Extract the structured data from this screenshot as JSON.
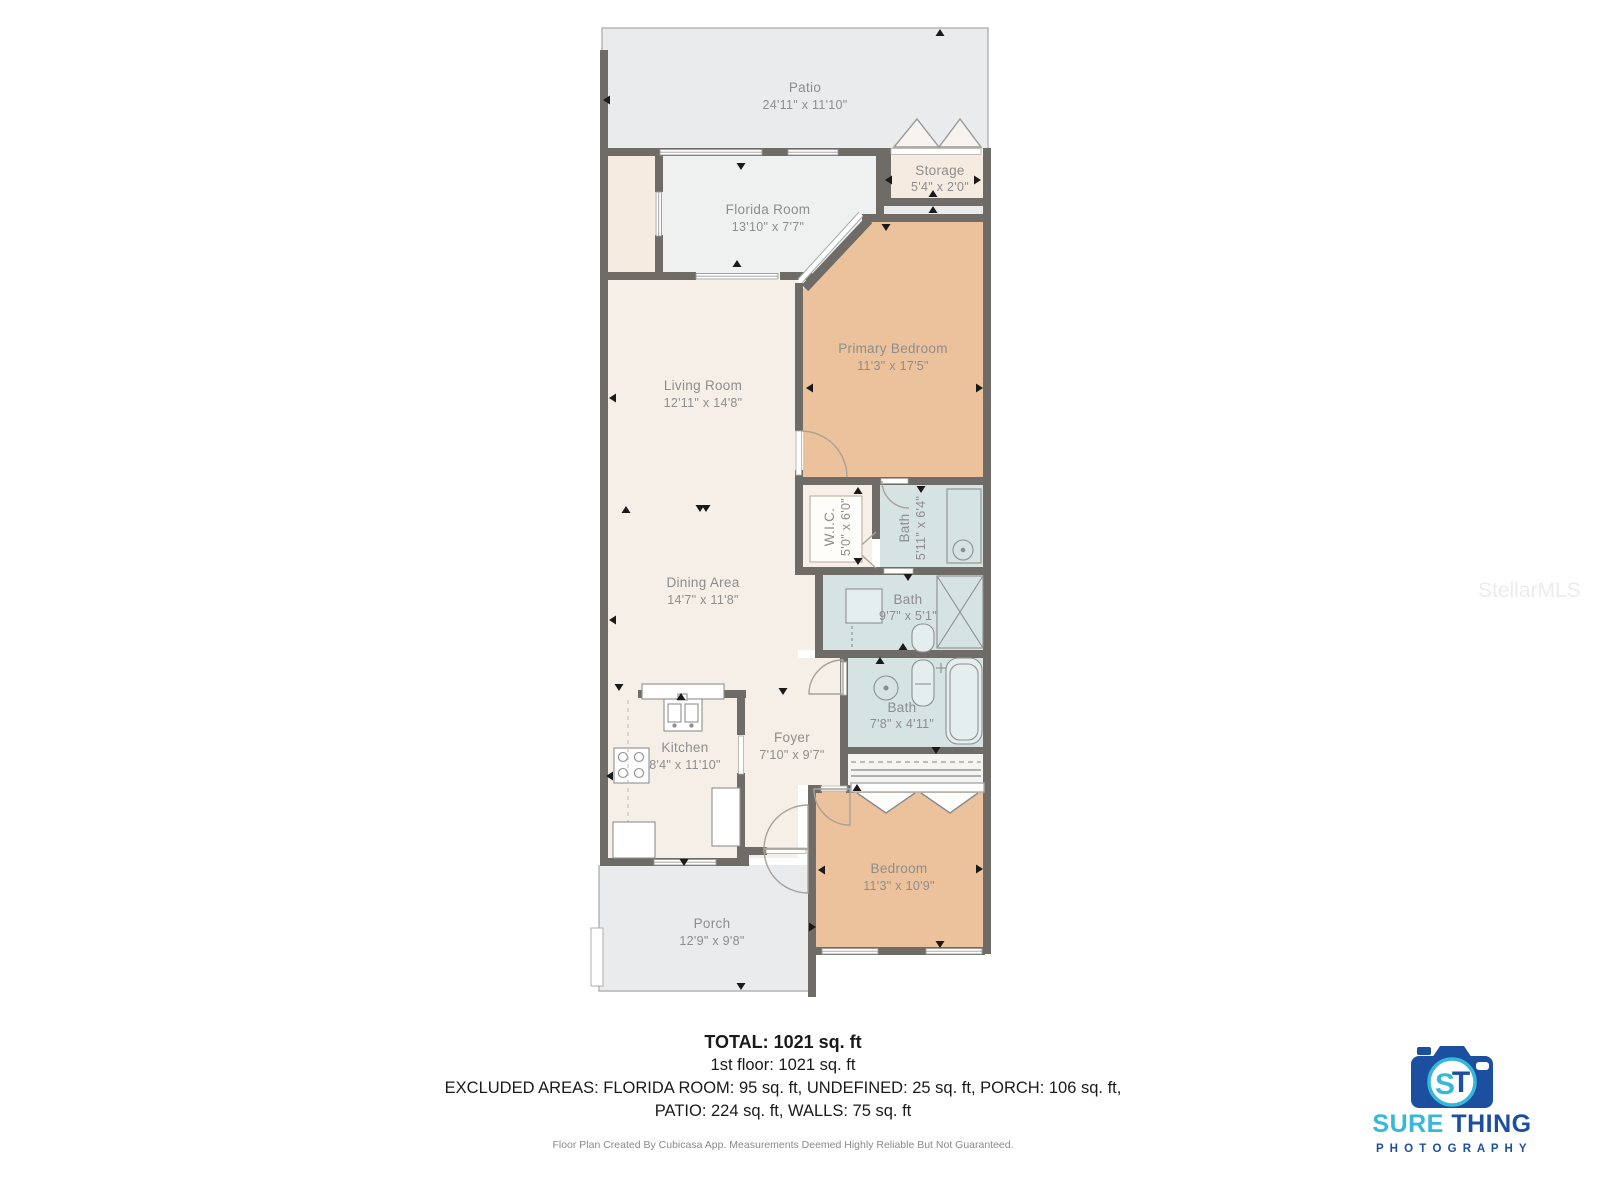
{
  "watermark": "StellarMLS",
  "rooms": {
    "patio": {
      "name": "Patio",
      "dims": "24'11\" x 11'10\""
    },
    "florida_room": {
      "name": "Florida Room",
      "dims": "13'10\" x 7'7\""
    },
    "storage": {
      "name": "Storage",
      "dims": "5'4\" x 2'0\""
    },
    "primary_bedroom": {
      "name": "Primary Bedroom",
      "dims": "11'3\" x 17'5\""
    },
    "living_room": {
      "name": "Living Room",
      "dims": "12'11\" x 14'8\""
    },
    "dining_area": {
      "name": "Dining Area",
      "dims": "14'7\" x 11'8\""
    },
    "wic": {
      "name": "W.I.C.",
      "dims": "5'0\" x 6'0\""
    },
    "bath_upper": {
      "name": "Bath",
      "dims": "5'11\" x 6'4\""
    },
    "bath_middle": {
      "name": "Bath",
      "dims": "9'7\" x 5'1\""
    },
    "bath_lower": {
      "name": "Bath",
      "dims": "7'8\" x 4'11\""
    },
    "kitchen": {
      "name": "Kitchen",
      "dims": "8'4\" x 11'10\""
    },
    "foyer": {
      "name": "Foyer",
      "dims": "7'10\" x 9'7\""
    },
    "bedroom": {
      "name": "Bedroom",
      "dims": "11'3\" x 10'9\""
    },
    "porch": {
      "name": "Porch",
      "dims": "12'9\" x 9'8\""
    }
  },
  "summary": {
    "total": "TOTAL: 1021 sq. ft",
    "first_floor": "1st floor: 1021 sq. ft",
    "excluded_line1": "EXCLUDED AREAS: FLORIDA ROOM: 95 sq. ft, UNDEFINED: 25 sq. ft, PORCH: 106 sq. ft,",
    "excluded_line2": "PATIO: 224 sq. ft, WALLS: 75 sq. ft",
    "disclaimer": "Floor Plan Created By Cubicasa App. Measurements Deemed Highly Reliable But Not Guaranteed."
  },
  "logo": {
    "monogram_s": "S",
    "monogram_t": "T",
    "word_sure": "SURE",
    "word_thing": " THING",
    "word_photography": "P H O T O G R A P H Y"
  },
  "colors": {
    "wall": "#6f6b67",
    "floor_living": "#f6efe7",
    "floor_bedroom": "#ecc29c",
    "floor_bath": "#d5e3e3",
    "floor_outdoor": "#e9ebed",
    "floor_florida": "#eff1f1",
    "floor_closet": "#f8f0e8",
    "logo_blue": "#1d4fa0",
    "logo_cyan": "#35b8dc"
  }
}
